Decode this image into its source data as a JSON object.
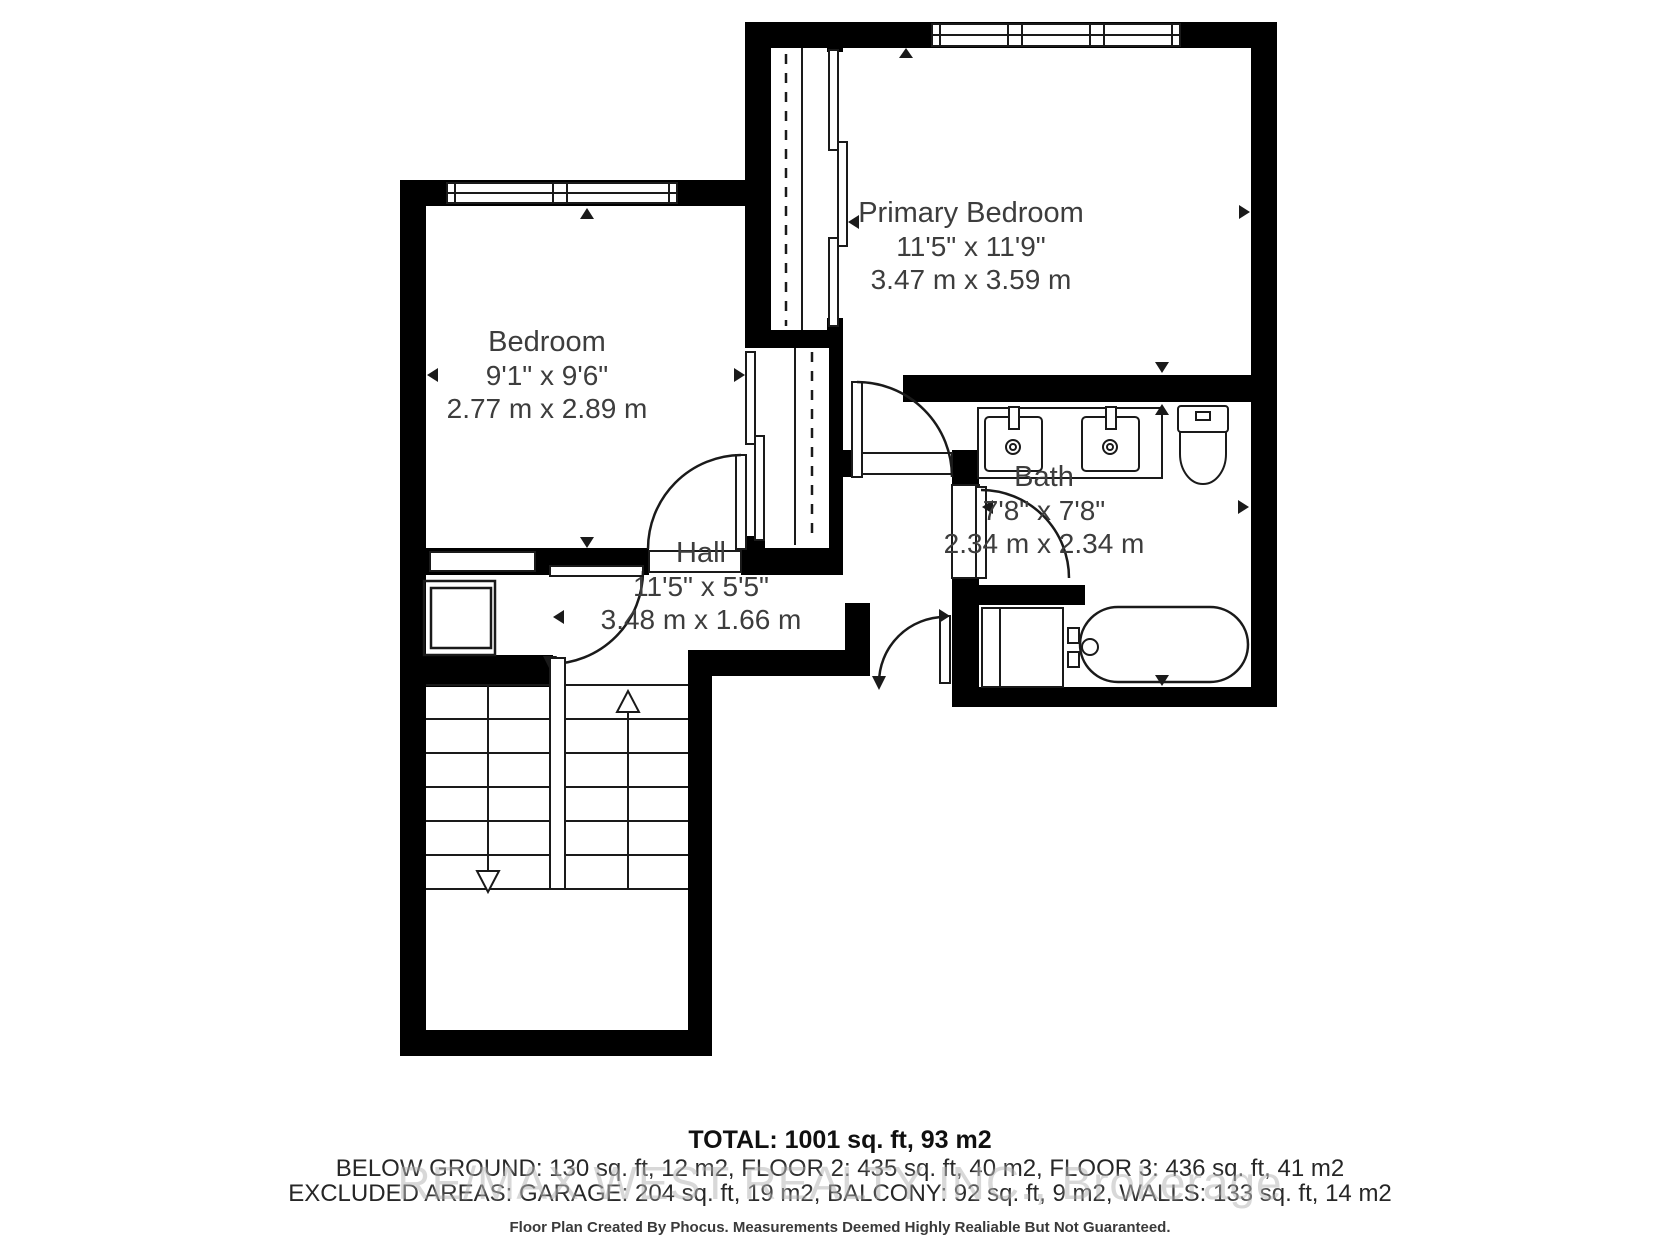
{
  "plan": {
    "rooms": [
      {
        "id": "primary-bedroom",
        "name": "Primary Bedroom",
        "dim_ft": "11'5\" x 11'9\"",
        "dim_m": "3.47 m x 3.59 m"
      },
      {
        "id": "bedroom",
        "name": "Bedroom",
        "dim_ft": "9'1\" x 9'6\"",
        "dim_m": "2.77 m x 2.89 m"
      },
      {
        "id": "bath",
        "name": "Bath",
        "dim_ft": "7'8\" x 7'8\"",
        "dim_m": "2.34 m x 2.34 m"
      },
      {
        "id": "hall",
        "name": "Hall",
        "dim_ft": "11'5\" x 5'5\"",
        "dim_m": "3.48 m x 1.66 m"
      }
    ],
    "fixtures": [
      "window",
      "door-swing",
      "sliding-closet-door",
      "closet-rail-dashed",
      "double-sink-vanity",
      "toilet",
      "bathtub",
      "stairs-up-arrow",
      "stairs-down-arrow",
      "linen-closet"
    ],
    "colors": {
      "wall": "#000000",
      "line": "#1a1a1a",
      "text": "#3d3d3d",
      "watermark": "#b9b9b9",
      "background": "#ffffff"
    }
  },
  "footer": {
    "total": "TOTAL: 1001 sq. ft, 93 m2",
    "areas_line": "BELOW GROUND: 130 sq. ft, 12 m2, FLOOR 2: 435 sq. ft, 40 m2, FLOOR 3: 436 sq. ft, 41 m2",
    "excluded_line": "EXCLUDED AREAS: GARAGE: 204 sq. ft, 19 m2, BALCONY: 92 sq. ft, 9 m2, WALLS: 133 sq. ft, 14 m2",
    "watermark": "RE/MAX WEST REALTY INC., Brokerage",
    "disclaimer": "Floor Plan Created By Phocus. Measurements Deemed Highly Realiable But Not Guaranteed."
  }
}
